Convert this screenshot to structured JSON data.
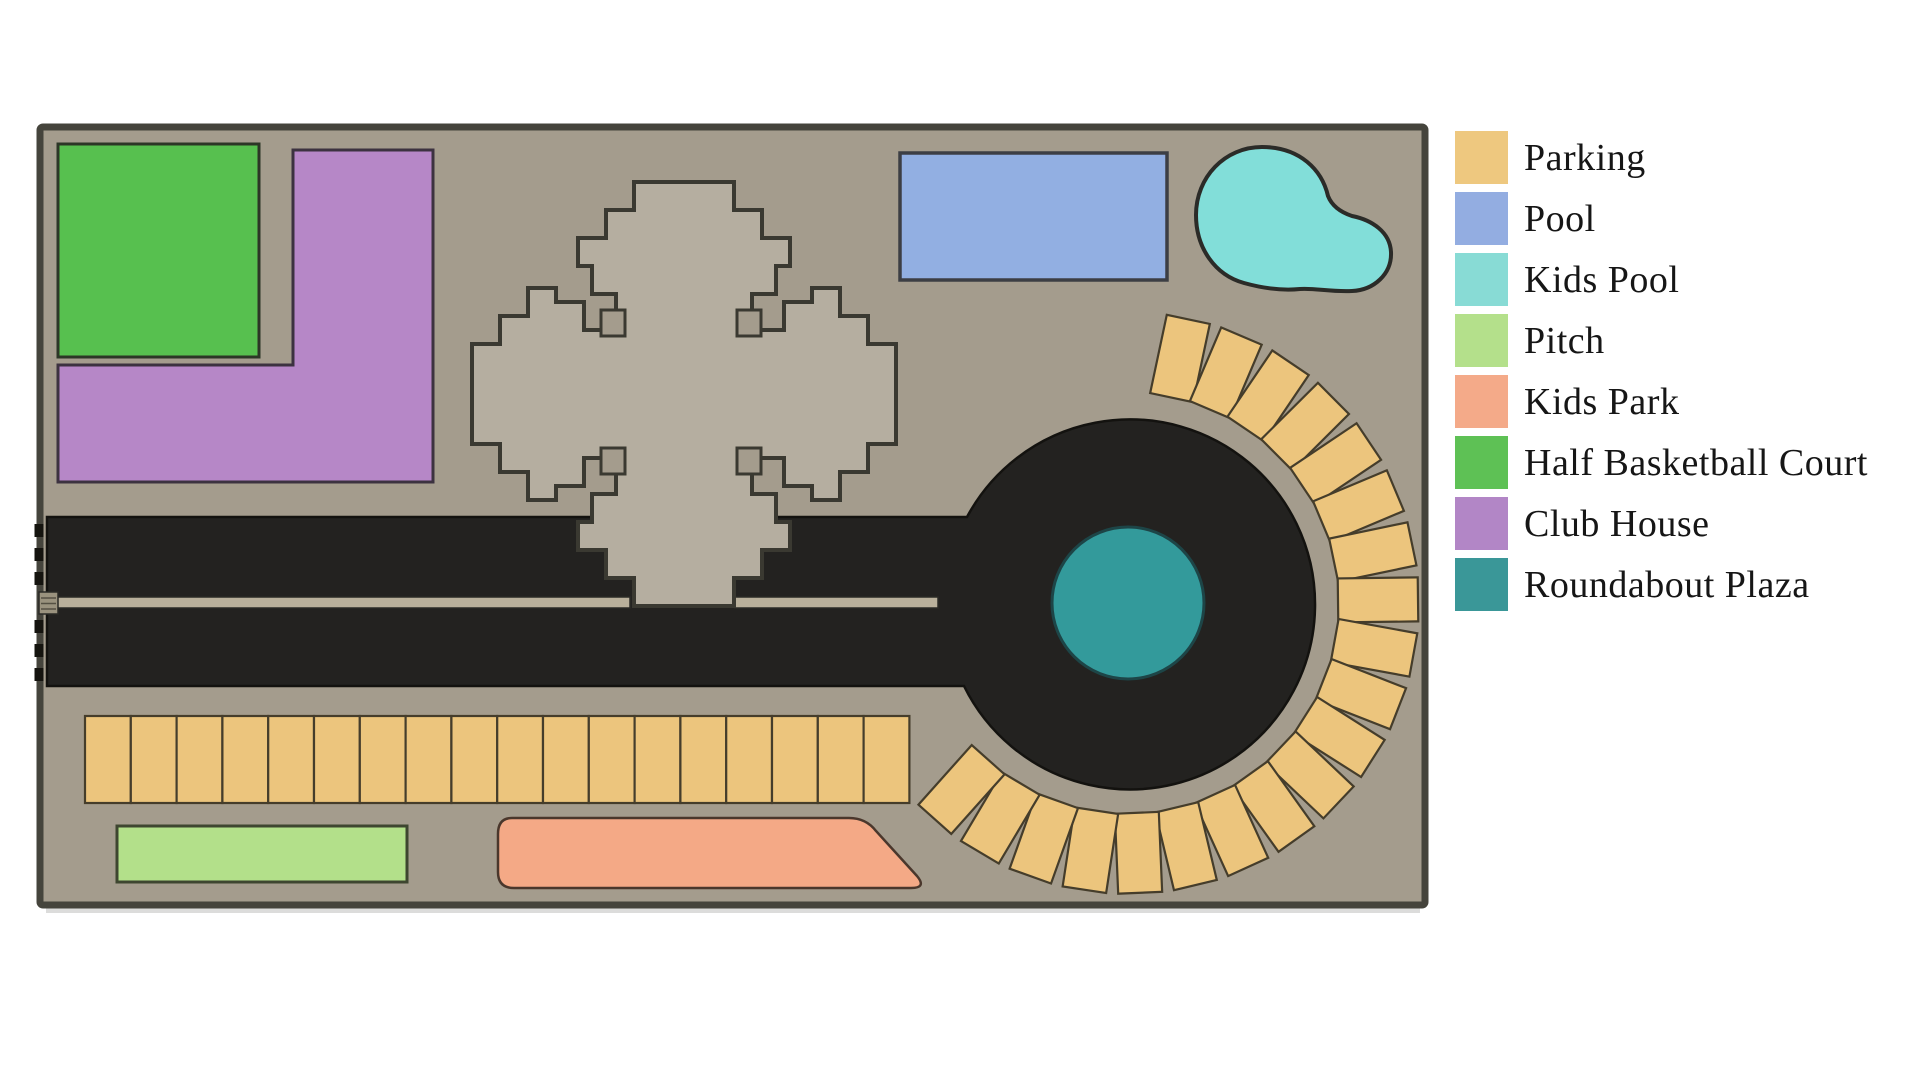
{
  "page": {
    "background": "#ffffff"
  },
  "legend": {
    "items": [
      {
        "id": "parking",
        "label": "Parking",
        "color": "#eec87f"
      },
      {
        "id": "pool",
        "label": "Pool",
        "color": "#93ade1"
      },
      {
        "id": "kids-pool",
        "label": "Kids Pool",
        "color": "#88dbd5"
      },
      {
        "id": "pitch",
        "label": "Pitch",
        "color": "#b4e08b"
      },
      {
        "id": "kids-park",
        "label": "Kids Park",
        "color": "#f4aa89"
      },
      {
        "id": "half-basketball-court",
        "label": "Half Basketball Court",
        "color": "#5ec155"
      },
      {
        "id": "club-house",
        "label": "Club House",
        "color": "#b286c6"
      },
      {
        "id": "roundabout-plaza",
        "label": "Roundabout Plaza",
        "color": "#3a9798"
      }
    ]
  },
  "site_plan": {
    "ground_color": "#a49c8d",
    "border_color": "#45443c",
    "building_color": "#b5aea0",
    "building_outline": "#3a3931",
    "road": {
      "color": "#232220",
      "outline": "#13120f",
      "median_color": "#b9b09b",
      "median_outline": "#2b2a26"
    },
    "roundabout": {
      "cx": 1128,
      "cy": 603,
      "road_radius": 185,
      "plaza_radius": 76,
      "plaza_color": "#339a9b",
      "plaza_outline": "#1d4547"
    },
    "areas": {
      "half_basketball_court": {
        "color": "#57c04f",
        "outline": "#2c3626"
      },
      "club_house": {
        "color": "#b687c7",
        "outline": "#3c3240"
      },
      "pool": {
        "color": "#92afe2",
        "outline": "#3c3e44"
      },
      "kids_pool": {
        "color": "#82ded9",
        "outline": "#2b2b28"
      },
      "pitch": {
        "color": "#b3e08a",
        "outline": "#3e4630"
      },
      "kids_park": {
        "color": "#f4a986",
        "outline": "#4a372c"
      }
    },
    "parking": {
      "fill": "#ecc57d",
      "stroke": "#453d2b",
      "row": {
        "x": 85,
        "y": 716,
        "count": 18,
        "stall_w": 45.8,
        "stall_h": 87
      },
      "ring": {
        "count": 20,
        "start_deg": 78,
        "step_deg": 11.04,
        "inner_r": 210,
        "stall_len": 80,
        "stall_w": 44
      }
    }
  }
}
